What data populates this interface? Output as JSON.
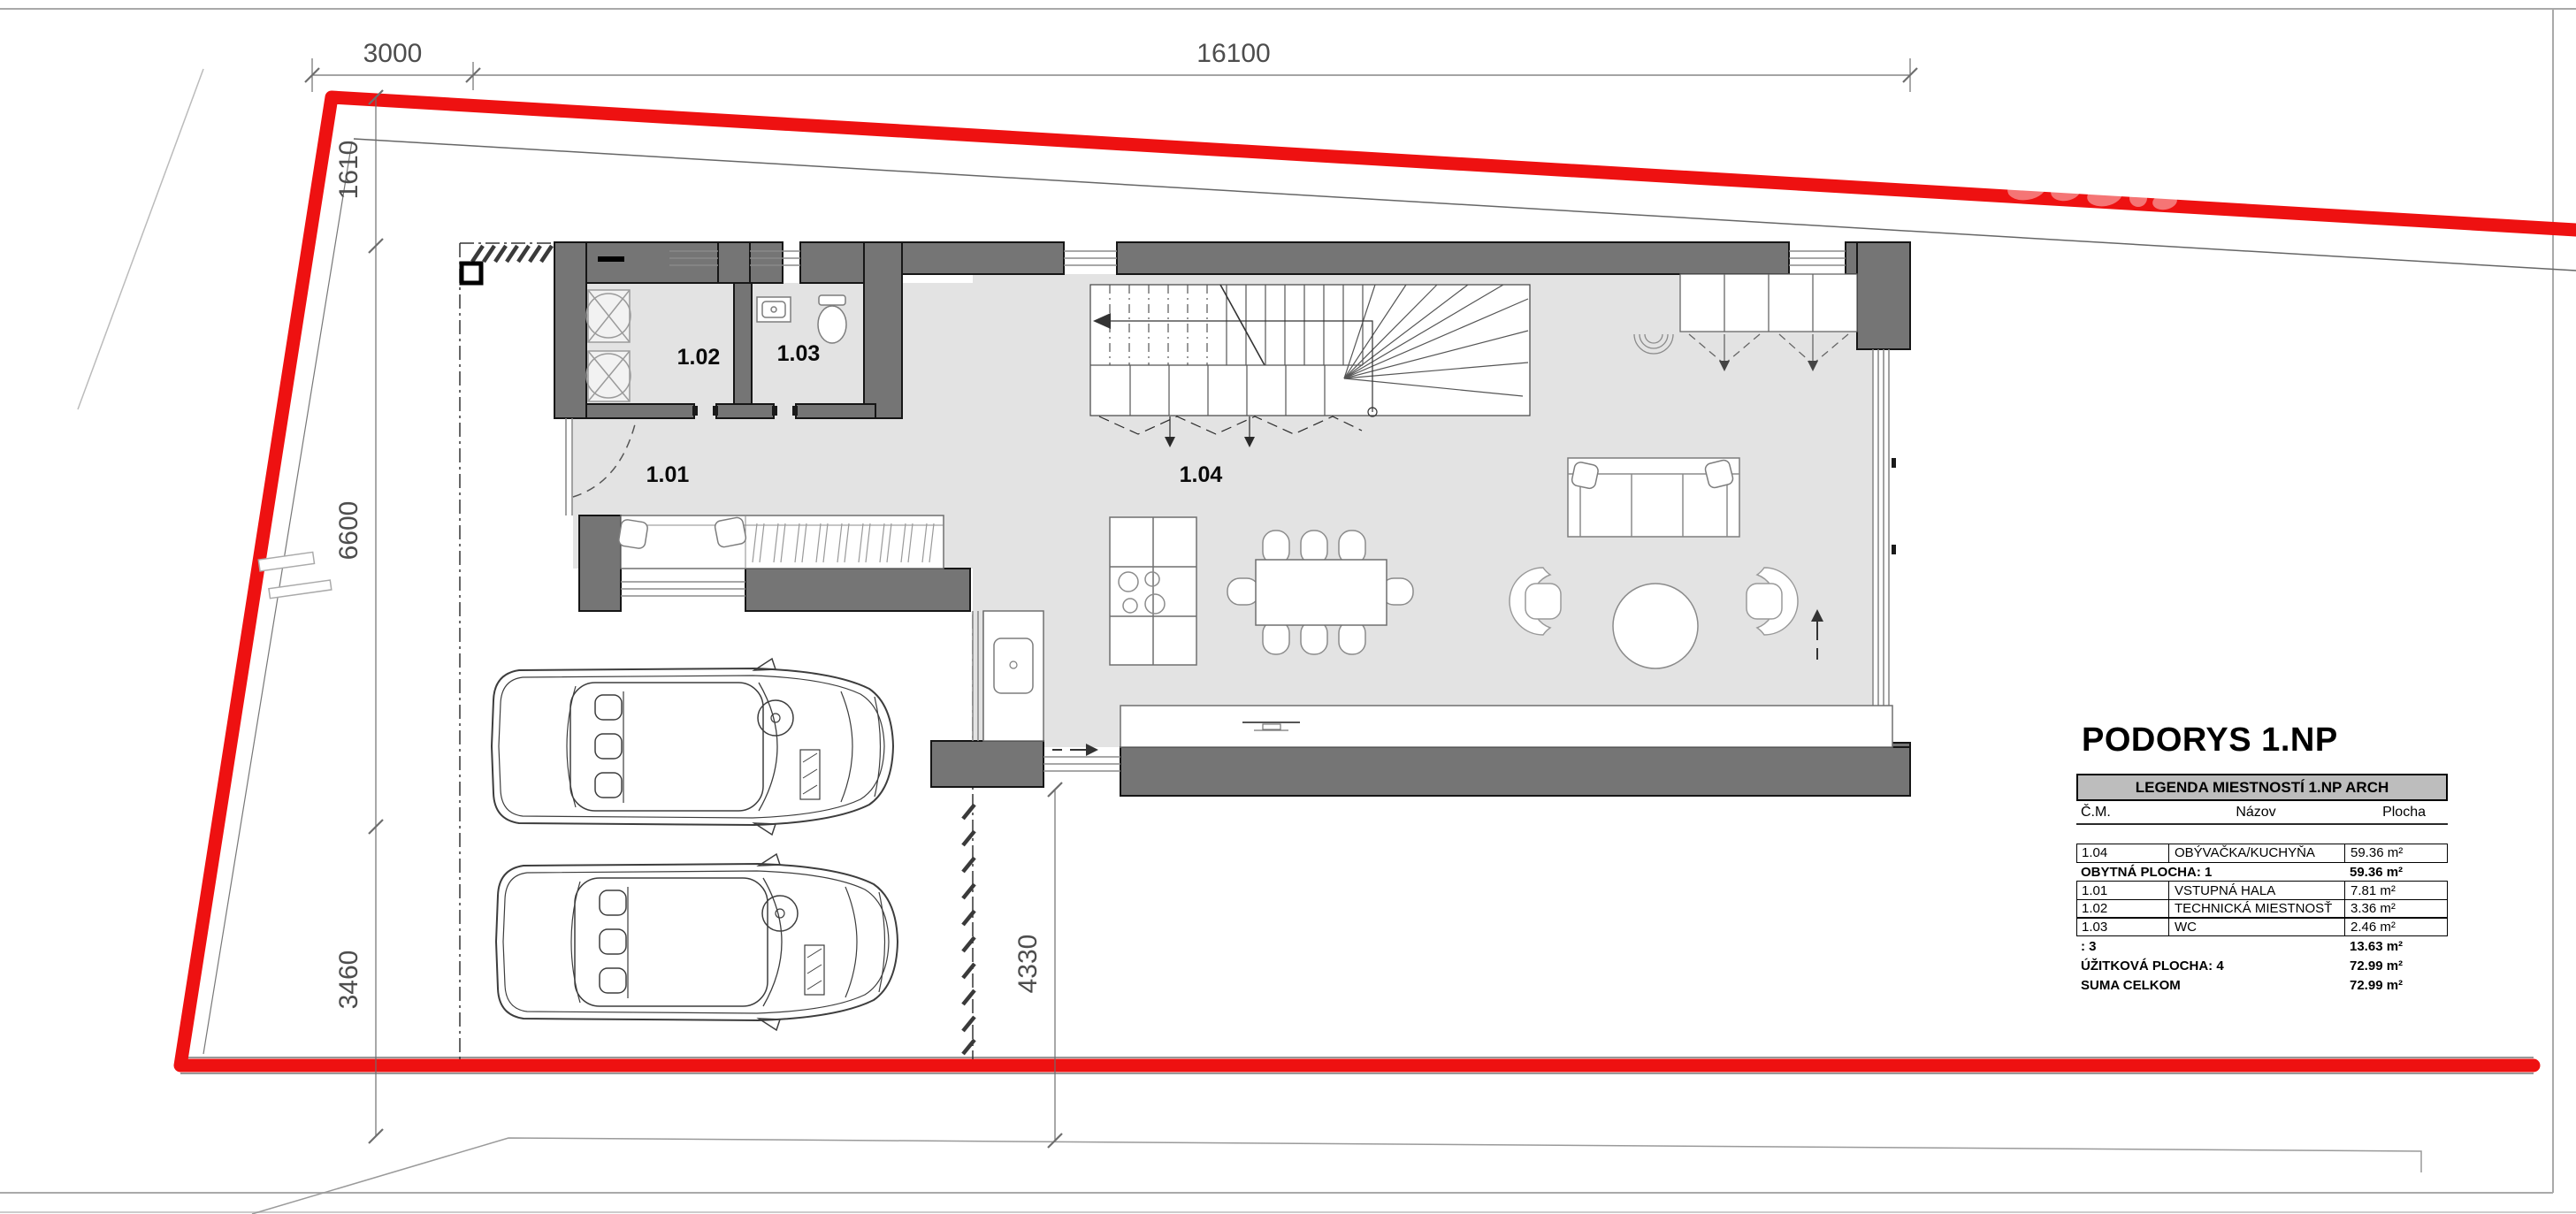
{
  "title": "PODORYS 1.NP",
  "dimensions": {
    "top_left": "3000",
    "top_main": "16100",
    "left_top": "1610",
    "left_mid": "6600",
    "left_bottom": "3460",
    "bottom": "4330"
  },
  "rooms": {
    "r101": "1.01",
    "r102": "1.02",
    "r103": "1.03",
    "r104": "1.04"
  },
  "legend": {
    "header": "LEGENDA MIESTNOSTÍ 1.NP ARCH",
    "columns": {
      "cm": "Č.M.",
      "nazov": "Názov",
      "plocha": "Plocha"
    },
    "rows": [
      {
        "cm": "1.04",
        "nazov": "OBÝVAČKA/KUCHYŇA",
        "plocha": "59.36 m²"
      },
      {
        "cm": "OBYTNÁ PLOCHA: 1",
        "nazov": "",
        "plocha": "59.36 m²"
      },
      {
        "cm": "1.01",
        "nazov": "VSTUPNÁ HALA",
        "plocha": "7.81 m²"
      },
      {
        "cm": "1.02",
        "nazov": "TECHNICKÁ MIESTNOSŤ",
        "plocha": "3.36 m²"
      },
      {
        "cm": "1.03",
        "nazov": "WC",
        "plocha": "2.46 m²"
      },
      {
        "cm": ": 3",
        "nazov": "",
        "plocha": "13.63 m²"
      },
      {
        "cm": "ÚŽITKOVÁ PLOCHA: 4",
        "nazov": "",
        "plocha": "72.99 m²"
      },
      {
        "cm": "SUMA CELKOM",
        "nazov": "",
        "plocha": "72.99 m²"
      }
    ]
  },
  "colors": {
    "boundary_red": "#ee1111",
    "wall_gray": "#757575",
    "floor_gray": "#e3e3e3",
    "legend_header_bg": "#bdbdbd"
  }
}
